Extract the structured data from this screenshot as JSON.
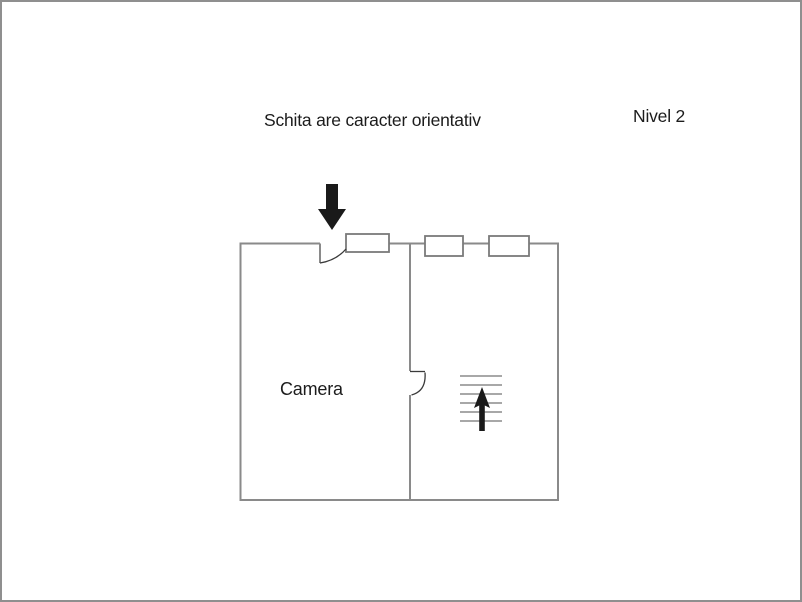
{
  "page": {
    "background": "#ffffff",
    "frame_color": "#8f8f8f"
  },
  "labels": {
    "disclaimer": "Schita are caracter orientativ",
    "level": "Nivel 2",
    "room": "Camera"
  },
  "colors": {
    "wall": "#8a8a8a",
    "window_frame": "#7a7a7a",
    "stairs": "#9c9c9c",
    "door_arc": "#3a3a3a",
    "arrow": "#1a1a1a",
    "text": "#1c1c1c"
  },
  "plan": {
    "type": "floor-plan-sketch",
    "windows_count": 3,
    "stairs_steps": 6,
    "entrance_direction": "down-into-plan",
    "stairs_direction": "up"
  }
}
